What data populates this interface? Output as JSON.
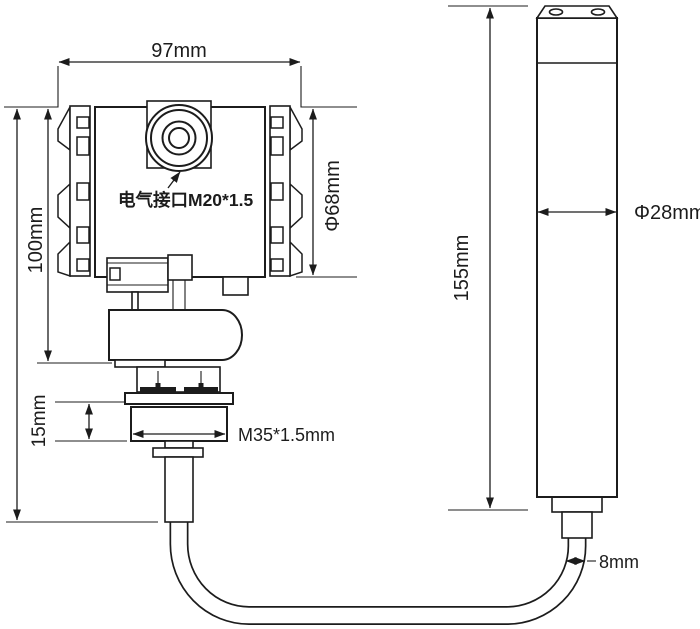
{
  "drawing": {
    "labels": {
      "top_width": "97mm",
      "left_height": "100mm",
      "body_diameter": "Φ68mm",
      "electrical_interface": "电气接口M20*1.5",
      "mount_height": "15mm",
      "thread_spec": "M35*1.5mm",
      "probe_length": "155mm",
      "probe_diameter": "Φ28mm",
      "cable_diameter": "8mm"
    },
    "colors": {
      "line": "#1c1c1c",
      "background": "#ffffff"
    }
  }
}
